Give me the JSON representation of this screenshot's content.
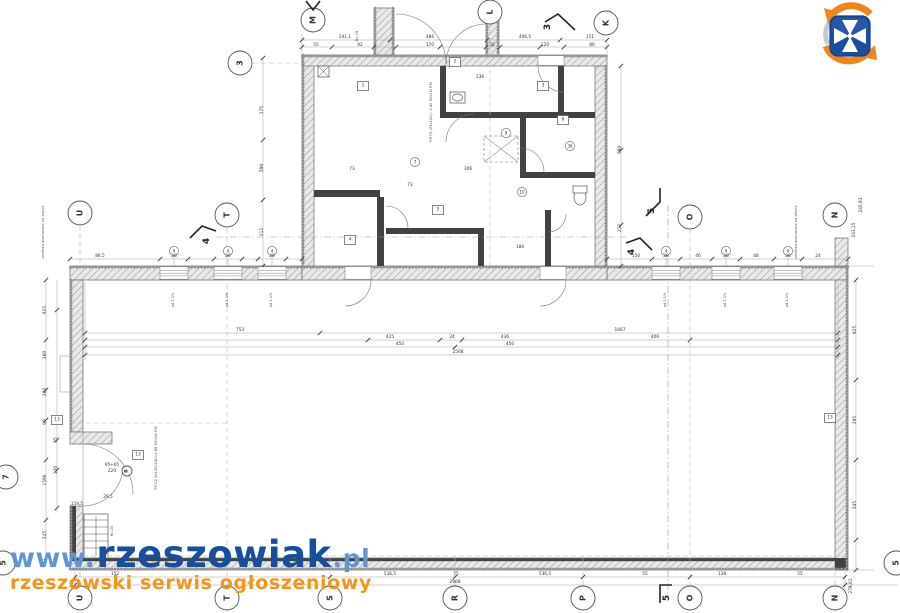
{
  "watermark": {
    "prefix": "www.",
    "brand": "rzeszowiak",
    "suffix": ".pl",
    "tagline": "rzeszowski serwis ogłoszeniowy"
  },
  "logo": {
    "name": "rzeszowiak-logo"
  },
  "colors": {
    "watermark_blue": "#164f9e",
    "watermark_light_blue": "#5f95d2",
    "watermark_orange": "#f5941e",
    "logo_blue": "#1d4e9e",
    "logo_orange": "#f0861b",
    "logo_grey": "#c2cbd8",
    "drawing_line": "#6b6b6b"
  },
  "plan": {
    "window_label": "pd 3.1%",
    "axis_circles": [
      {
        "label": "M",
        "x": 313,
        "y": 20
      },
      {
        "label": "L",
        "x": 490,
        "y": 12
      },
      {
        "label": "K",
        "x": 606,
        "y": 23
      },
      {
        "label": "3",
        "x": 240,
        "y": 63
      },
      {
        "label": "U",
        "x": 80,
        "y": 213
      },
      {
        "label": "T",
        "x": 227,
        "y": 215
      },
      {
        "label": "O",
        "x": 690,
        "y": 217
      },
      {
        "label": "N",
        "x": 835,
        "y": 215
      },
      {
        "label": "7",
        "x": 6,
        "y": 477
      },
      {
        "label": "5",
        "x": 3,
        "y": 563
      },
      {
        "label": "5",
        "x": 896,
        "y": 563
      },
      {
        "label": "U",
        "x": 80,
        "y": 598
      },
      {
        "label": "T",
        "x": 227,
        "y": 598
      },
      {
        "label": "S",
        "x": 330,
        "y": 598
      },
      {
        "label": "R",
        "x": 455,
        "y": 598
      },
      {
        "label": "P",
        "x": 583,
        "y": 598
      },
      {
        "label": "O",
        "x": 690,
        "y": 598
      },
      {
        "label": "N",
        "x": 835,
        "y": 598
      },
      {
        "label": "B",
        "x": 127,
        "y": 471,
        "r": 5
      }
    ],
    "ref_circles": [
      {
        "t": "4",
        "x": 174,
        "y": 251
      },
      {
        "t": "4",
        "x": 228,
        "y": 251
      },
      {
        "t": "4",
        "x": 272,
        "y": 251
      },
      {
        "t": "4",
        "x": 666,
        "y": 251
      },
      {
        "t": "4",
        "x": 726,
        "y": 251
      },
      {
        "t": "4",
        "x": 788,
        "y": 251
      },
      {
        "t": "9",
        "x": 506,
        "y": 133
      },
      {
        "t": "36",
        "x": 570,
        "y": 146
      },
      {
        "t": "10",
        "x": 522,
        "y": 192
      },
      {
        "t": "7",
        "x": 415,
        "y": 162
      }
    ],
    "section_markers": [
      {
        "label": "3",
        "points": "575,30 558,14 545,22",
        "lx": 548,
        "ly": 27
      },
      {
        "label": "",
        "points": "306,1 313,10 320,1",
        "lx": 0,
        "ly": 0
      },
      {
        "label": "4",
        "points": "190,238 202,226 216,231",
        "lx": 207,
        "ly": 241
      },
      {
        "label": "4",
        "points": "652,250 640,238 626,243",
        "lx": 632,
        "ly": 252
      },
      {
        "label": "5",
        "points": "646,216 660,202 660,188",
        "lx": 652,
        "ly": 211
      },
      {
        "label": "5",
        "points": "660,603 660,585 672,585",
        "lx": 667,
        "ly": 598
      }
    ],
    "windows": [
      {
        "x": 160,
        "w": 28
      },
      {
        "x": 214,
        "w": 28
      },
      {
        "x": 258,
        "w": 28
      },
      {
        "x": 652,
        "w": 28
      },
      {
        "x": 712,
        "w": 28
      },
      {
        "x": 774,
        "w": 28
      }
    ],
    "boxes": [
      {
        "t": "1",
        "x": 363,
        "y": 86
      },
      {
        "t": "2",
        "x": 455,
        "y": 62
      },
      {
        "t": "3",
        "x": 543,
        "y": 86
      },
      {
        "t": "4",
        "x": 350,
        "y": 240
      },
      {
        "t": "5",
        "x": 438,
        "y": 210
      },
      {
        "t": "6",
        "x": 563,
        "y": 120
      },
      {
        "t": "13",
        "x": 57,
        "y": 420
      },
      {
        "t": "13",
        "x": 138,
        "y": 455
      },
      {
        "t": "13",
        "x": 830,
        "y": 418
      }
    ],
    "dim_labels": [
      {
        "t": "241,1",
        "x": 345,
        "y": 38
      },
      {
        "t": "486",
        "x": 430,
        "y": 38
      },
      {
        "t": "406,5",
        "x": 525,
        "y": 38
      },
      {
        "t": "151",
        "x": 590,
        "y": 38
      },
      {
        "t": "55",
        "x": 316,
        "y": 46
      },
      {
        "t": "92",
        "x": 360,
        "y": 46
      },
      {
        "t": "170",
        "x": 430,
        "y": 46
      },
      {
        "t": "58",
        "x": 492,
        "y": 46
      },
      {
        "t": "120",
        "x": 545,
        "y": 46
      },
      {
        "t": "86",
        "x": 592,
        "y": 46
      },
      {
        "t": "86,5",
        "x": 100,
        "y": 257
      },
      {
        "t": "28",
        "x": 174,
        "y": 257
      },
      {
        "t": "26",
        "x": 228,
        "y": 257
      },
      {
        "t": "28",
        "x": 272,
        "y": 257
      },
      {
        "t": "150",
        "x": 636,
        "y": 257
      },
      {
        "t": "28",
        "x": 666,
        "y": 257
      },
      {
        "t": "46",
        "x": 698,
        "y": 257
      },
      {
        "t": "28",
        "x": 726,
        "y": 257
      },
      {
        "t": "48",
        "x": 756,
        "y": 257
      },
      {
        "t": "28",
        "x": 788,
        "y": 257
      },
      {
        "t": "24",
        "x": 818,
        "y": 257
      },
      {
        "t": "753",
        "x": 240,
        "y": 331
      },
      {
        "t": "1667",
        "x": 620,
        "y": 331
      },
      {
        "t": "425",
        "x": 390,
        "y": 338
      },
      {
        "t": "24",
        "x": 452,
        "y": 338
      },
      {
        "t": "436",
        "x": 505,
        "y": 338
      },
      {
        "t": "406",
        "x": 655,
        "y": 338
      },
      {
        "t": "450",
        "x": 400,
        "y": 345
      },
      {
        "t": "450",
        "x": 510,
        "y": 345
      },
      {
        "t": "2568",
        "x": 458,
        "y": 353
      },
      {
        "t": "152",
        "x": 115,
        "y": 575
      },
      {
        "t": "536,5",
        "x": 390,
        "y": 575
      },
      {
        "t": "75",
        "x": 456,
        "y": 575
      },
      {
        "t": "536,5",
        "x": 545,
        "y": 575
      },
      {
        "t": "55",
        "x": 645,
        "y": 575
      },
      {
        "t": "138",
        "x": 722,
        "y": 575
      },
      {
        "t": "55",
        "x": 800,
        "y": 575
      },
      {
        "t": "2668",
        "x": 455,
        "y": 583
      },
      {
        "t": "925",
        "x": 46,
        "y": 310,
        "r": 1
      },
      {
        "t": "160",
        "x": 46,
        "y": 355,
        "r": 1
      },
      {
        "t": "208",
        "x": 46,
        "y": 392,
        "r": 1
      },
      {
        "t": "90",
        "x": 46,
        "y": 422,
        "r": 1
      },
      {
        "t": "1590",
        "x": 46,
        "y": 480,
        "r": 1
      },
      {
        "t": "245",
        "x": 46,
        "y": 535,
        "r": 1
      },
      {
        "t": "55",
        "x": 57,
        "y": 440,
        "r": 1
      },
      {
        "t": "120",
        "x": 57,
        "y": 470,
        "r": 1
      },
      {
        "t": "175",
        "x": 263,
        "y": 110,
        "r": 1
      },
      {
        "t": "590",
        "x": 263,
        "y": 168,
        "r": 1
      },
      {
        "t": "212",
        "x": 263,
        "y": 232,
        "r": 1
      },
      {
        "t": "590",
        "x": 621,
        "y": 150,
        "r": 1
      },
      {
        "t": "212",
        "x": 621,
        "y": 228,
        "r": 1
      },
      {
        "t": "243,15",
        "x": 855,
        "y": 230,
        "r": 1
      },
      {
        "t": "245,93",
        "x": 862,
        "y": 205,
        "r": 1
      },
      {
        "t": "925",
        "x": 856,
        "y": 330,
        "r": 1
      },
      {
        "t": "295",
        "x": 856,
        "y": 420,
        "r": 1
      },
      {
        "t": "245",
        "x": 856,
        "y": 505,
        "r": 1
      },
      {
        "t": "279,81",
        "x": 852,
        "y": 586,
        "r": 1
      },
      {
        "t": "119,5",
        "x": 77,
        "y": 505
      },
      {
        "t": "29,5",
        "x": 108,
        "y": 498
      },
      {
        "t": "95+65",
        "x": 112,
        "y": 466
      },
      {
        "t": "220",
        "x": 112,
        "y": 472
      },
      {
        "t": "306",
        "x": 468,
        "y": 170
      },
      {
        "t": "73",
        "x": 352,
        "y": 170
      },
      {
        "t": "236",
        "x": 480,
        "y": 78
      },
      {
        "t": "186",
        "x": 520,
        "y": 248
      },
      {
        "t": "73",
        "x": 410,
        "y": 186
      }
    ],
    "annotations": [
      {
        "t": "P.P.75 (25x120) - 2,40  50x1M P.M",
        "x": 432,
        "y": 112,
        "r": 1
      },
      {
        "t": "P.P.O2 5x120x240=2,88  50x1M P.M",
        "x": 157,
        "y": 458,
        "r": 1
      },
      {
        "t": "obróbka blacharska na attyce",
        "x": 44,
        "y": 232,
        "r": 1
      },
      {
        "t": "obróbka blacharska na attyce",
        "x": 797,
        "y": 232,
        "r": 1
      },
      {
        "t": "Hp 25",
        "x": 358,
        "y": 36,
        "r": 1
      },
      {
        "t": "Hp 25",
        "x": 113,
        "y": 531,
        "r": 1
      }
    ]
  }
}
